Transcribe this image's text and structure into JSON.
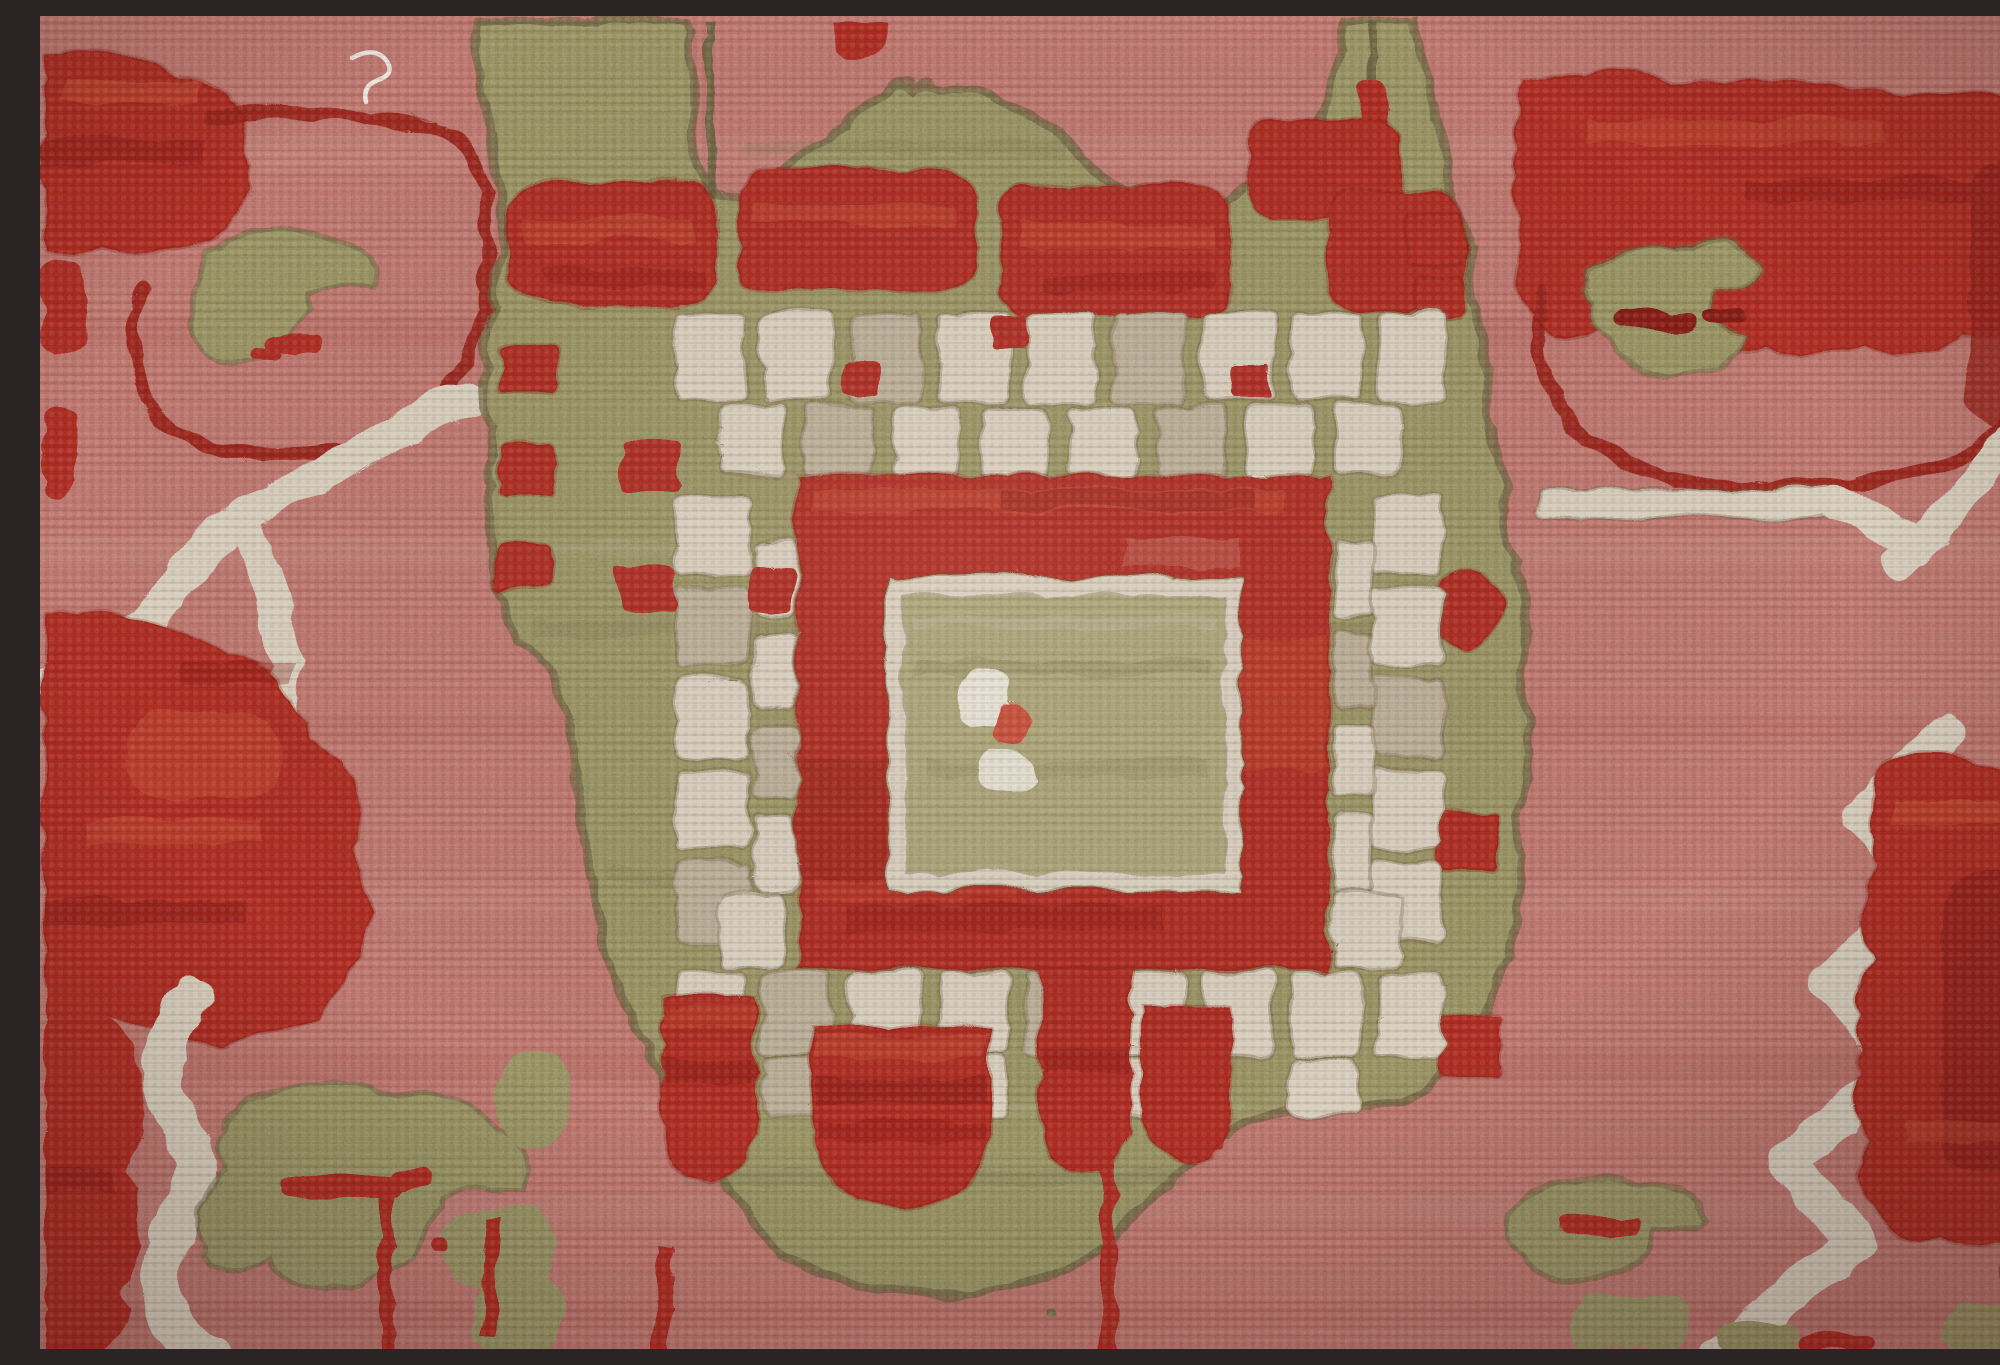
{
  "meta": {
    "domain": "natural-image",
    "subject": "hand-knotted wool rug, close-up photograph",
    "style": "Oushak / Arts-and-Crafts geometric medallion carpet detail"
  },
  "image": {
    "width": 2000,
    "height": 1333,
    "alt": "Close-up photograph of a hand-knotted wool rug: a rose-pink field with a large olive-green stepped medallion. The medallion holds a cream crenellated ring around a brick-red square, which frames a light olive center square with a small cream-and-red dot cluster. Dark red blossom motifs, olive leaf and crescent shapes, and ivory branch forks fill the corners, all rendered in chunky knotted wool pile."
  },
  "palette": {
    "field_pink": "#b76f6a",
    "field_pink_light": "#c9837d",
    "field_pink_dark": "#a35e5a",
    "green_mid": "#8f8b61",
    "green_light": "#a29d73",
    "green_dark": "#6f6a47",
    "green_outline": "#615c3e",
    "cream": "#d5cbbb",
    "cream_bright": "#e6e0d4",
    "cream_shadow": "#b4a892",
    "red_brick": "#a52a20",
    "red_bright": "#c14a38",
    "red_deep": "#7a1a15",
    "red_maroon": "#8c1f1a",
    "brown_outline": "#6b5c44",
    "thread_white": "#efece6"
  },
  "motifs": [
    {
      "name": "field",
      "color": "field_pink",
      "region": "entire background with horizontal weave banding"
    },
    {
      "name": "medallion-body",
      "color": "green_mid",
      "region": "x 440-1480, y 55-1270, stepped olive mass with crown at top"
    },
    {
      "name": "crown-stems",
      "color": "green_outline",
      "region": "thin vertical stems at x 665 and x 1330 reaching top edge"
    },
    {
      "name": "top-band-flowers",
      "color": "red_brick",
      "region": "red blossoms across medallion shoulder, y 150-300"
    },
    {
      "name": "checker-squares",
      "color": "red_brick",
      "region": "small red squares on left arm x 450-520 and right arm x 1360-1470"
    },
    {
      "name": "crenellated-ring",
      "color": "cream",
      "region": "castellated ivory ring x 630-1400, y 290-1100"
    },
    {
      "name": "ring-red-accents",
      "color": "red_brick",
      "region": "small red squares tucked between cream teeth"
    },
    {
      "name": "red-ring",
      "color": "red_brick",
      "region": "square brick-red band x 755-1285, y 455-950"
    },
    {
      "name": "inner-cream-border",
      "color": "cream",
      "region": "thin frame x 843-1197, y 558-870"
    },
    {
      "name": "center-square",
      "color": "green_light",
      "region": "light olive core x 861-1179, y 576-852"
    },
    {
      "name": "center-dots",
      "color": "cream_bright",
      "region": "cream-red-cream dot cluster near x 915-990, y 650-775"
    },
    {
      "name": "pendant-shields",
      "color": "red_brick",
      "region": "four red pendants hanging below ring, y 945-1185"
    },
    {
      "name": "top-left-blossom",
      "color": "red_brick",
      "region": "corner x 0-210, y 35-230"
    },
    {
      "name": "top-left-ring-outline",
      "color": "red_maroon",
      "region": "thin red loop x 90-445, y 95-430 around pink"
    },
    {
      "name": "top-left-crescent",
      "color": "green_mid",
      "region": "olive crescent x 150-335, y 210-355 with red tick"
    },
    {
      "name": "left-branch-fork",
      "color": "cream",
      "region": "ivory Y-branch x 0-430, y 380-710"
    },
    {
      "name": "left-cream-bar",
      "color": "cream",
      "region": "horizontal ivory bar x 0-236, y 696-724"
    },
    {
      "name": "bottom-left-blossom",
      "color": "red_brick",
      "region": "large red mass x 0-340, y 585-1030 and corner column to bottom"
    },
    {
      "name": "bottom-left-branch",
      "color": "cream",
      "region": "wavy ivory branch x 95-175, y 975-1333"
    },
    {
      "name": "bottom-left-leaf",
      "color": "green_mid",
      "region": "olive leaf x 150-500, y 1060-1280 with red smile mark"
    },
    {
      "name": "bottom-left-vine",
      "color": "green_mid",
      "region": "olive blobs x 390-530, y 1030-1333"
    },
    {
      "name": "top-right-blossom",
      "color": "red_brick",
      "region": "red band x 1470-2000, y 50-330 with maroon column"
    },
    {
      "name": "top-right-ring-outline",
      "color": "red_maroon",
      "region": "red arc x 1490-1980, y 260-470"
    },
    {
      "name": "top-right-crescent",
      "color": "green_mid",
      "region": "olive crescent x 1530-1720, y 220-355 with red tick"
    },
    {
      "name": "top-right-squiggle",
      "color": "red_brick",
      "region": "thin red squiggle near x 1740-1905, y 58-95"
    },
    {
      "name": "right-cream-bar",
      "color": "cream",
      "region": "ivory bar x 1494-1790, y 470-500 and diagonal to right edge"
    },
    {
      "name": "bottom-right-branch",
      "color": "cream",
      "region": "ivory zigzag branch x 1680-1910, y 710-1333"
    },
    {
      "name": "bottom-right-blossom",
      "color": "red_brick",
      "region": "red column x 1795-2000, y 730-1240 with maroon core"
    },
    {
      "name": "bottom-right-leaf",
      "color": "green_mid",
      "region": "olive leaf x 1460-1660, y 1150-1265 with red mark"
    },
    {
      "name": "bottom-right-vine",
      "color": "green_mid",
      "region": "olive blobs along bottom edge x 1520-2000"
    },
    {
      "name": "bottom-stems",
      "color": "red_brick",
      "region": "thin red stems at x 336, 440, 612, 1058 descending to bottom"
    },
    {
      "name": "stray-thread",
      "color": "thread_white",
      "region": "loose white yarn wisp near x 310-360, y 40-80"
    }
  ],
  "texture": {
    "weave_row_height_px": 8,
    "knot_pitch_px": 9,
    "description": "chunky wool pile: horizontal knot rows, nubby highlights, wobbly motif edges, soft corner vignette"
  }
}
